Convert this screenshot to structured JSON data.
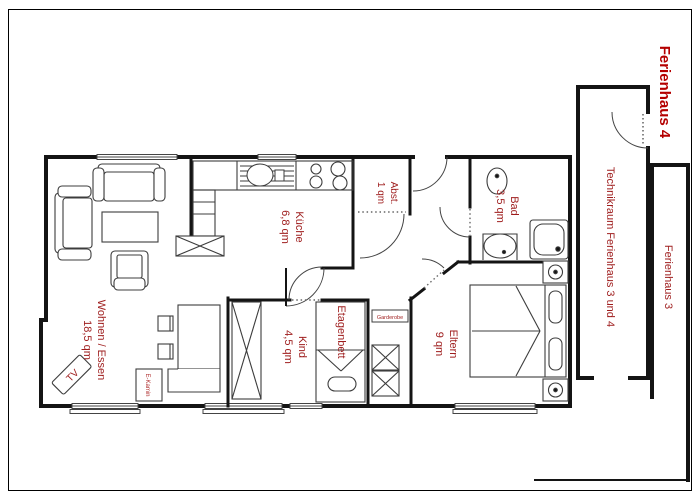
{
  "plan": {
    "title": "Ferienhaus 4",
    "rooms": [
      {
        "name": "Wohnen / Essen",
        "area": "18,5 qm"
      },
      {
        "name": "Küche",
        "area": "6,8 qm"
      },
      {
        "name": "Abst.",
        "area": "1 qm"
      },
      {
        "name": "Bad",
        "area": "3,5 qm"
      },
      {
        "name": "Kind",
        "area": "4,5 qm"
      },
      {
        "name": "Eltern",
        "area": "9 qm"
      },
      {
        "name": "Technikraum Ferienhaus 3 und 4"
      },
      {
        "name": "Ferienhaus 3"
      }
    ],
    "furniture": {
      "tv": "TV",
      "ekamin": "E-Kamin",
      "etagenbett": "Etagenbett",
      "garderobe": "Garderobe"
    },
    "colors": {
      "label_red": "#9e1c1c",
      "title_red": "#b40000",
      "wall": "#141414"
    }
  }
}
